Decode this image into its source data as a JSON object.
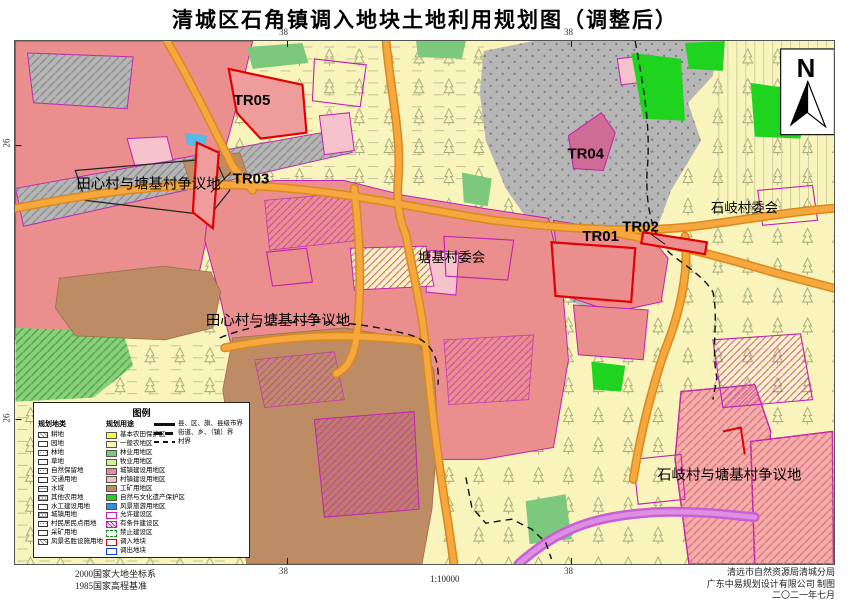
{
  "title": "清城区石角镇调入地块土地利用规划图（调整后）",
  "compass": {
    "north_label": "N"
  },
  "map_labels": {
    "tr05": "TR05",
    "tr04": "TR04",
    "tr03": "TR03",
    "tr02": "TR02",
    "tr01": "TR01",
    "dispute_tianxin_top": "田心村与塘基村争议地",
    "dispute_tianxin_mid": "田心村与塘基村争议地",
    "tangji_committee": "塘基村委会",
    "shiqi_committee": "石岐村委会",
    "dispute_shiqi_bottom": "石岐村与塘基村争议地"
  },
  "grid_coords": {
    "top_left": "38",
    "top_right": "38",
    "bottom_left": "38",
    "bottom_right": "38",
    "left_upper": "26",
    "left_lower": "26"
  },
  "legend": {
    "title": "图例",
    "landclass_header": "规划地类",
    "landclass_items": [
      {
        "label": "耕地",
        "pattern": "diag"
      },
      {
        "label": "园地",
        "pattern": "plain"
      },
      {
        "label": "林地",
        "pattern": "dots"
      },
      {
        "label": "草地",
        "pattern": "plain"
      },
      {
        "label": "自然保留地",
        "pattern": "dots"
      },
      {
        "label": "交通用地",
        "pattern": "plain"
      },
      {
        "label": "水域",
        "pattern": "wave"
      },
      {
        "label": "其他农用地",
        "pattern": "grid"
      },
      {
        "label": "水工建设用地",
        "pattern": "plain"
      },
      {
        "label": "城镇用地",
        "pattern": "grid"
      },
      {
        "label": "村民居民点用地",
        "pattern": "dots"
      },
      {
        "label": "采矿用地",
        "pattern": "plain"
      },
      {
        "label": "风景名胜设施用地",
        "pattern": "diag"
      }
    ],
    "use_header": "规划用途",
    "use_items": [
      {
        "label": "基本农田保护区",
        "fill": "#FFFF2E"
      },
      {
        "label": "一般农地区",
        "fill": "#FAFAAE"
      },
      {
        "label": "林业用地区",
        "fill": "#7CC87C"
      },
      {
        "label": "牧业用地区",
        "fill": "#CFF08A"
      },
      {
        "label": "城镇建设用地区",
        "fill": "#EA8E8E"
      },
      {
        "label": "村镇建设用地区",
        "fill": "#F6BEBE"
      },
      {
        "label": "工矿用地区",
        "fill": "#BE8C64"
      },
      {
        "label": "自然与文化遗产保护区",
        "fill": "#1FD41F"
      },
      {
        "label": "风景旅游用地区",
        "fill": "#2E8FE0"
      },
      {
        "label": "允许建设区",
        "outline": "#C020B0"
      },
      {
        "label": "有条件建设区",
        "outline": "#C020B0",
        "hatch": true
      },
      {
        "label": "禁止建设区",
        "outline_dashed": "#1C8A1C"
      },
      {
        "label": "调入地块",
        "outline": "#E30000"
      },
      {
        "label": "调出地块",
        "outline": "#1440E0"
      }
    ],
    "line_items": [
      {
        "label": "县、区、旗、县级市界",
        "style": "thick"
      },
      {
        "label": "街道、乡、（镇）界",
        "style": "seg"
      },
      {
        "label": "村界",
        "style": "dash"
      }
    ]
  },
  "footer": {
    "datum_line1": "2000国家大地坐标系",
    "datum_line2": "1985国家高程基准",
    "scale": "1:10000",
    "credit_line1": "清远市自然资源局清城分局",
    "credit_line2": "广东中易规划设计有限公司  制图",
    "credit_line3": "二〇二一年七月"
  },
  "colors": {
    "base_farmland": "#F8F4BC",
    "town_construction": "#EA8E8E",
    "village_construction": "#F6BEBE",
    "natural_reserve_gray": "#B6B6B6",
    "forest_green": "#7CC87C",
    "heritage_green": "#1FD41F",
    "mining_brown": "#BE8C64",
    "road_orange": "#F6A83F",
    "allowed_magenta": "#C020B0",
    "import_parcel_red": "#E30000",
    "river_violet": "#C95FD6"
  }
}
